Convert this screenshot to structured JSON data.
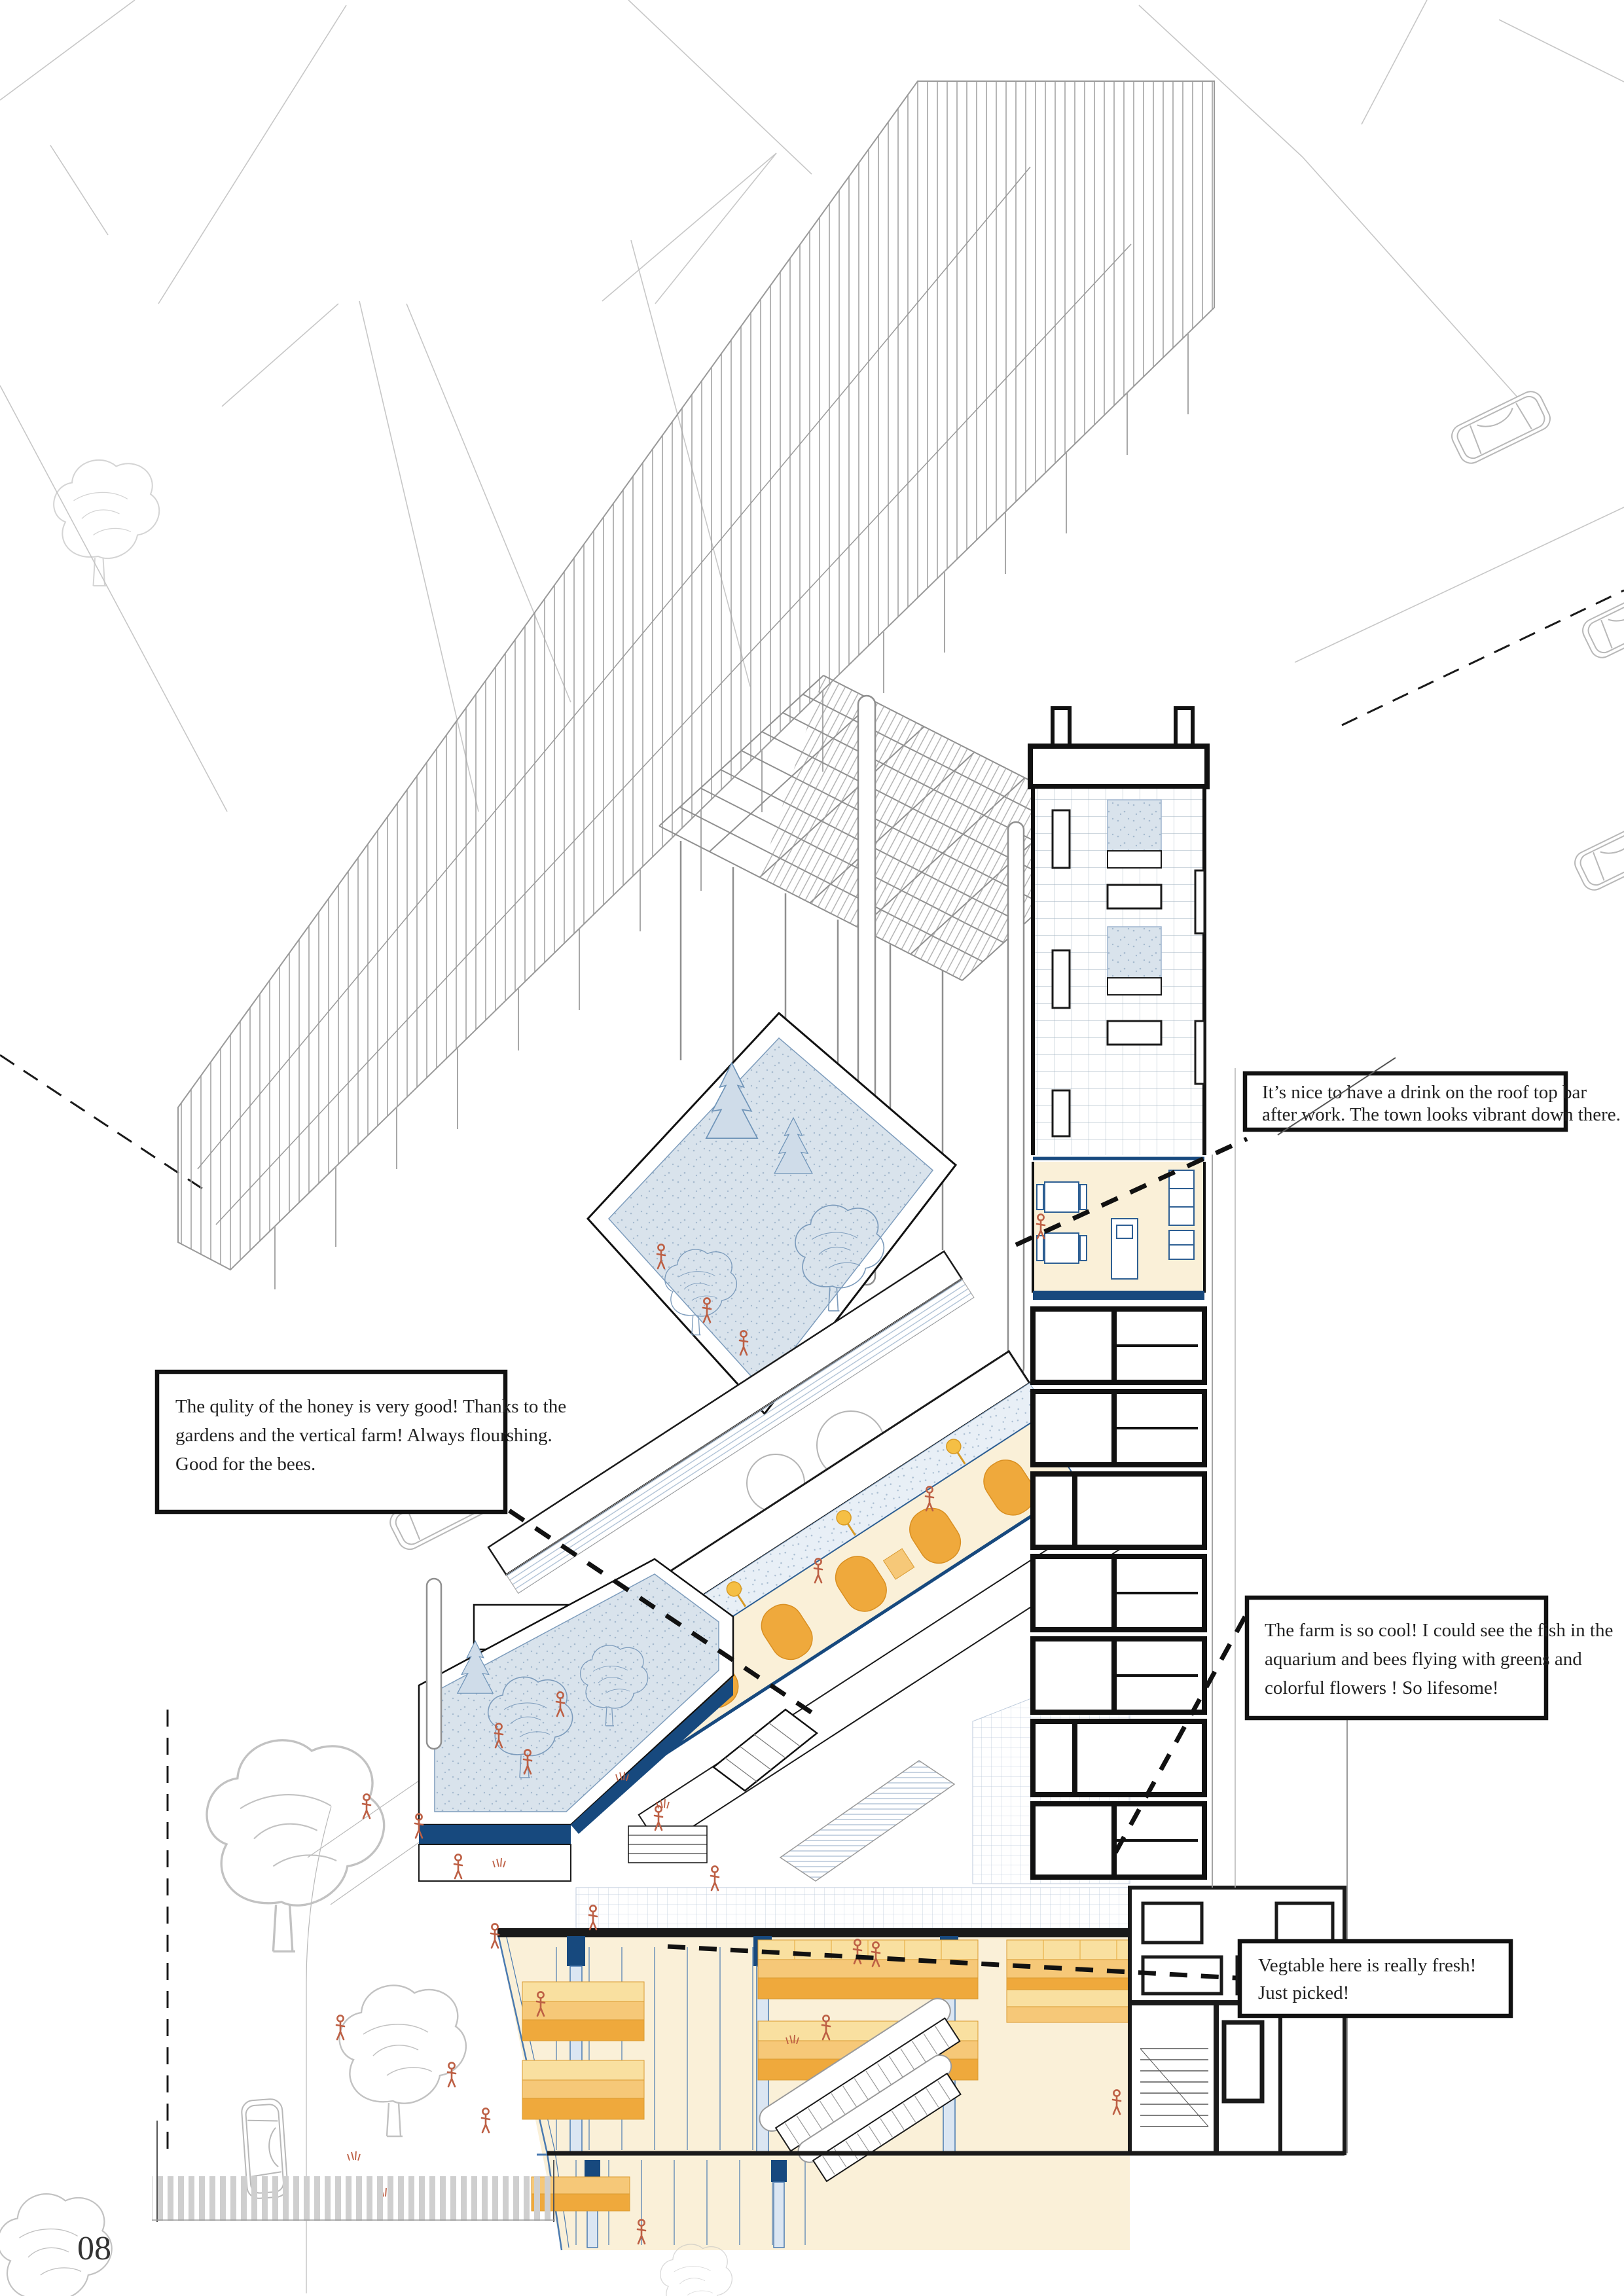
{
  "page": {
    "number": "08"
  },
  "palette": {
    "navy": "#17497e",
    "cream": "#faf0d8",
    "garden-blue": "#d9e3ec",
    "stall-light": "#f9e0a0",
    "stall-mid": "#f6c878",
    "stall-dark": "#efa93c",
    "lamp": "#f5bf45",
    "person": "#bd5f44",
    "column-blue": "#dbe6f2",
    "mullion": "#4a7ab0",
    "tree-blue": "#7d9cbc"
  },
  "callouts": {
    "rooftop_bar": {
      "lines": [
        "It’s nice to have a drink on the roof top bar",
        "after work. The town looks vibrant down there."
      ]
    },
    "honey": {
      "lines": [
        "The qulity of the honey is very good! Thanks to the",
        "gardens and the vertical farm! Always flourshing.",
        "Good for the bees."
      ]
    },
    "farm": {
      "lines": [
        "The farm is so cool!  I could see the fish in the",
        "aquarium and bees flying with greens and",
        "colorful flowers ! So lifesome!"
      ]
    },
    "vegetable": {
      "lines": [
        "Vegtable here is really fresh!",
        "Just picked!"
      ]
    }
  }
}
